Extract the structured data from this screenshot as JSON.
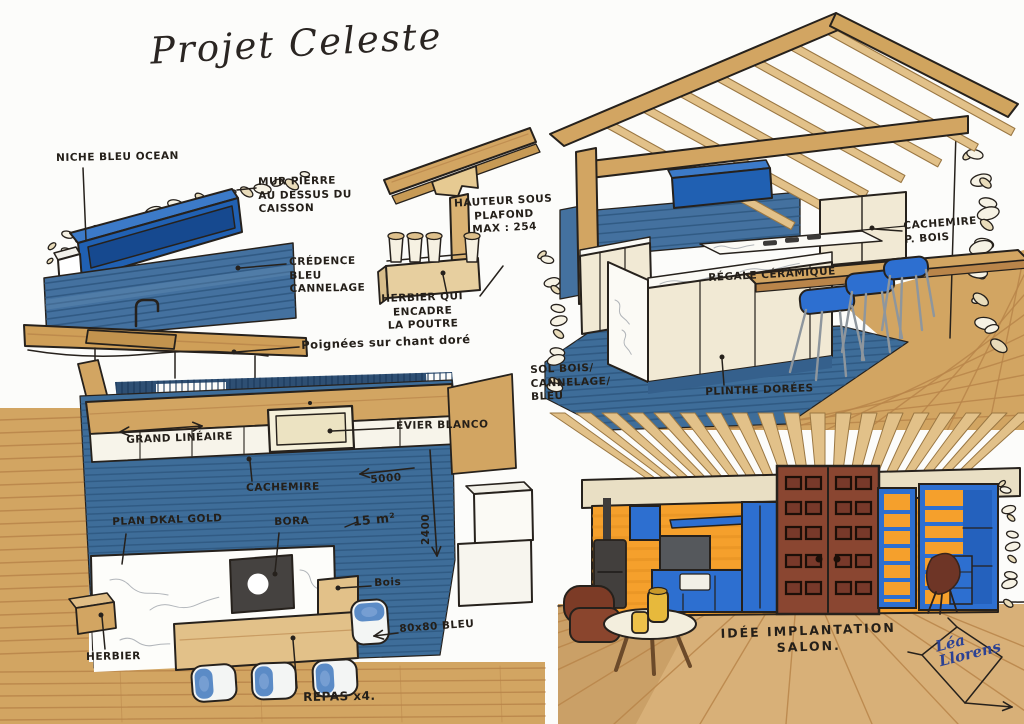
{
  "title": "Projet Celeste",
  "signature": "Léa\nLlorens",
  "colors": {
    "paper": "#fcfcfa",
    "ink": "#26211c",
    "wood": "#d2a562",
    "wood_light": "#e2c189",
    "wood_dark": "#b9854a",
    "cream": "#f1e9d4",
    "cream_dark": "#e3d7b8",
    "white_warm": "#fbfaf5",
    "blue_dark": "#2060b2",
    "blue_dark_top": "#3c7ac8",
    "blue_inset": "#16498f",
    "blue_steel": "#44719f",
    "blue_steel_line": "#2d567e",
    "blue_tile": "#3e6d99",
    "blue_bright": "#2d6fd0",
    "blue_chair": "#4a7fc1",
    "navy_band": "#2e4f73",
    "orange": "#f5a02c",
    "orange_dark": "#e08d1f",
    "door_brown": "#8a4631",
    "door_panel": "#1d0f08",
    "leather": "#7c3b26",
    "charcoal": "#454240",
    "steel_leg": "#8e969d",
    "marble_line": "#a8adb2",
    "yellow": "#e7b93c",
    "signature_blue": "#2c4294"
  },
  "panels": {
    "kitchen_elevation": {
      "labels": {
        "niche": "NICHE BLEU OCEAN",
        "mur_pierre": "MUR PIERRE\nAU DESSUS DU\nCAISSON",
        "credence": "CRÉDENCE\nBLEU\nCANNELAGE",
        "poignees": "Poignées sur chant doré"
      }
    },
    "beam_detail": {
      "labels": {
        "herbier_poutre": "HERBIER QUI ENCADRE\nLA POUTRE",
        "hauteur_plafond": "HAUTEUR SOUS\nPLAFOND\nMAX : 254"
      }
    },
    "kitchen_perspective": {
      "labels": {
        "regale_ceramique": "RÉGALE CÉRAMIQUE",
        "cachemire_bois": "CACHEMIRE\nP. BOIS",
        "sol_bois": "SOL BOIS/\nCANNELAGE/\nBLEU",
        "plinthe": "PLINTHE DORÉES"
      }
    },
    "kitchen_plan": {
      "labels": {
        "grand_lineaire": "GRAND LINÉAIRE",
        "evier_blanco": "EVIER BLANCO",
        "cachemire": "CACHEMIRE",
        "dim_longueur": "5000",
        "dim_profondeur": "2400",
        "plan_gold": "PLAN DKAL GOLD",
        "bora": "BORA",
        "surface": "15 m²",
        "bois": "Bois",
        "carrelage": "80x80 BLEU",
        "herbier": "HERBIER",
        "repas": "REPAS x4."
      }
    },
    "salon": {
      "labels": {
        "idee_implantation": "IDÉE IMPLANTATION\nSALON."
      }
    }
  }
}
